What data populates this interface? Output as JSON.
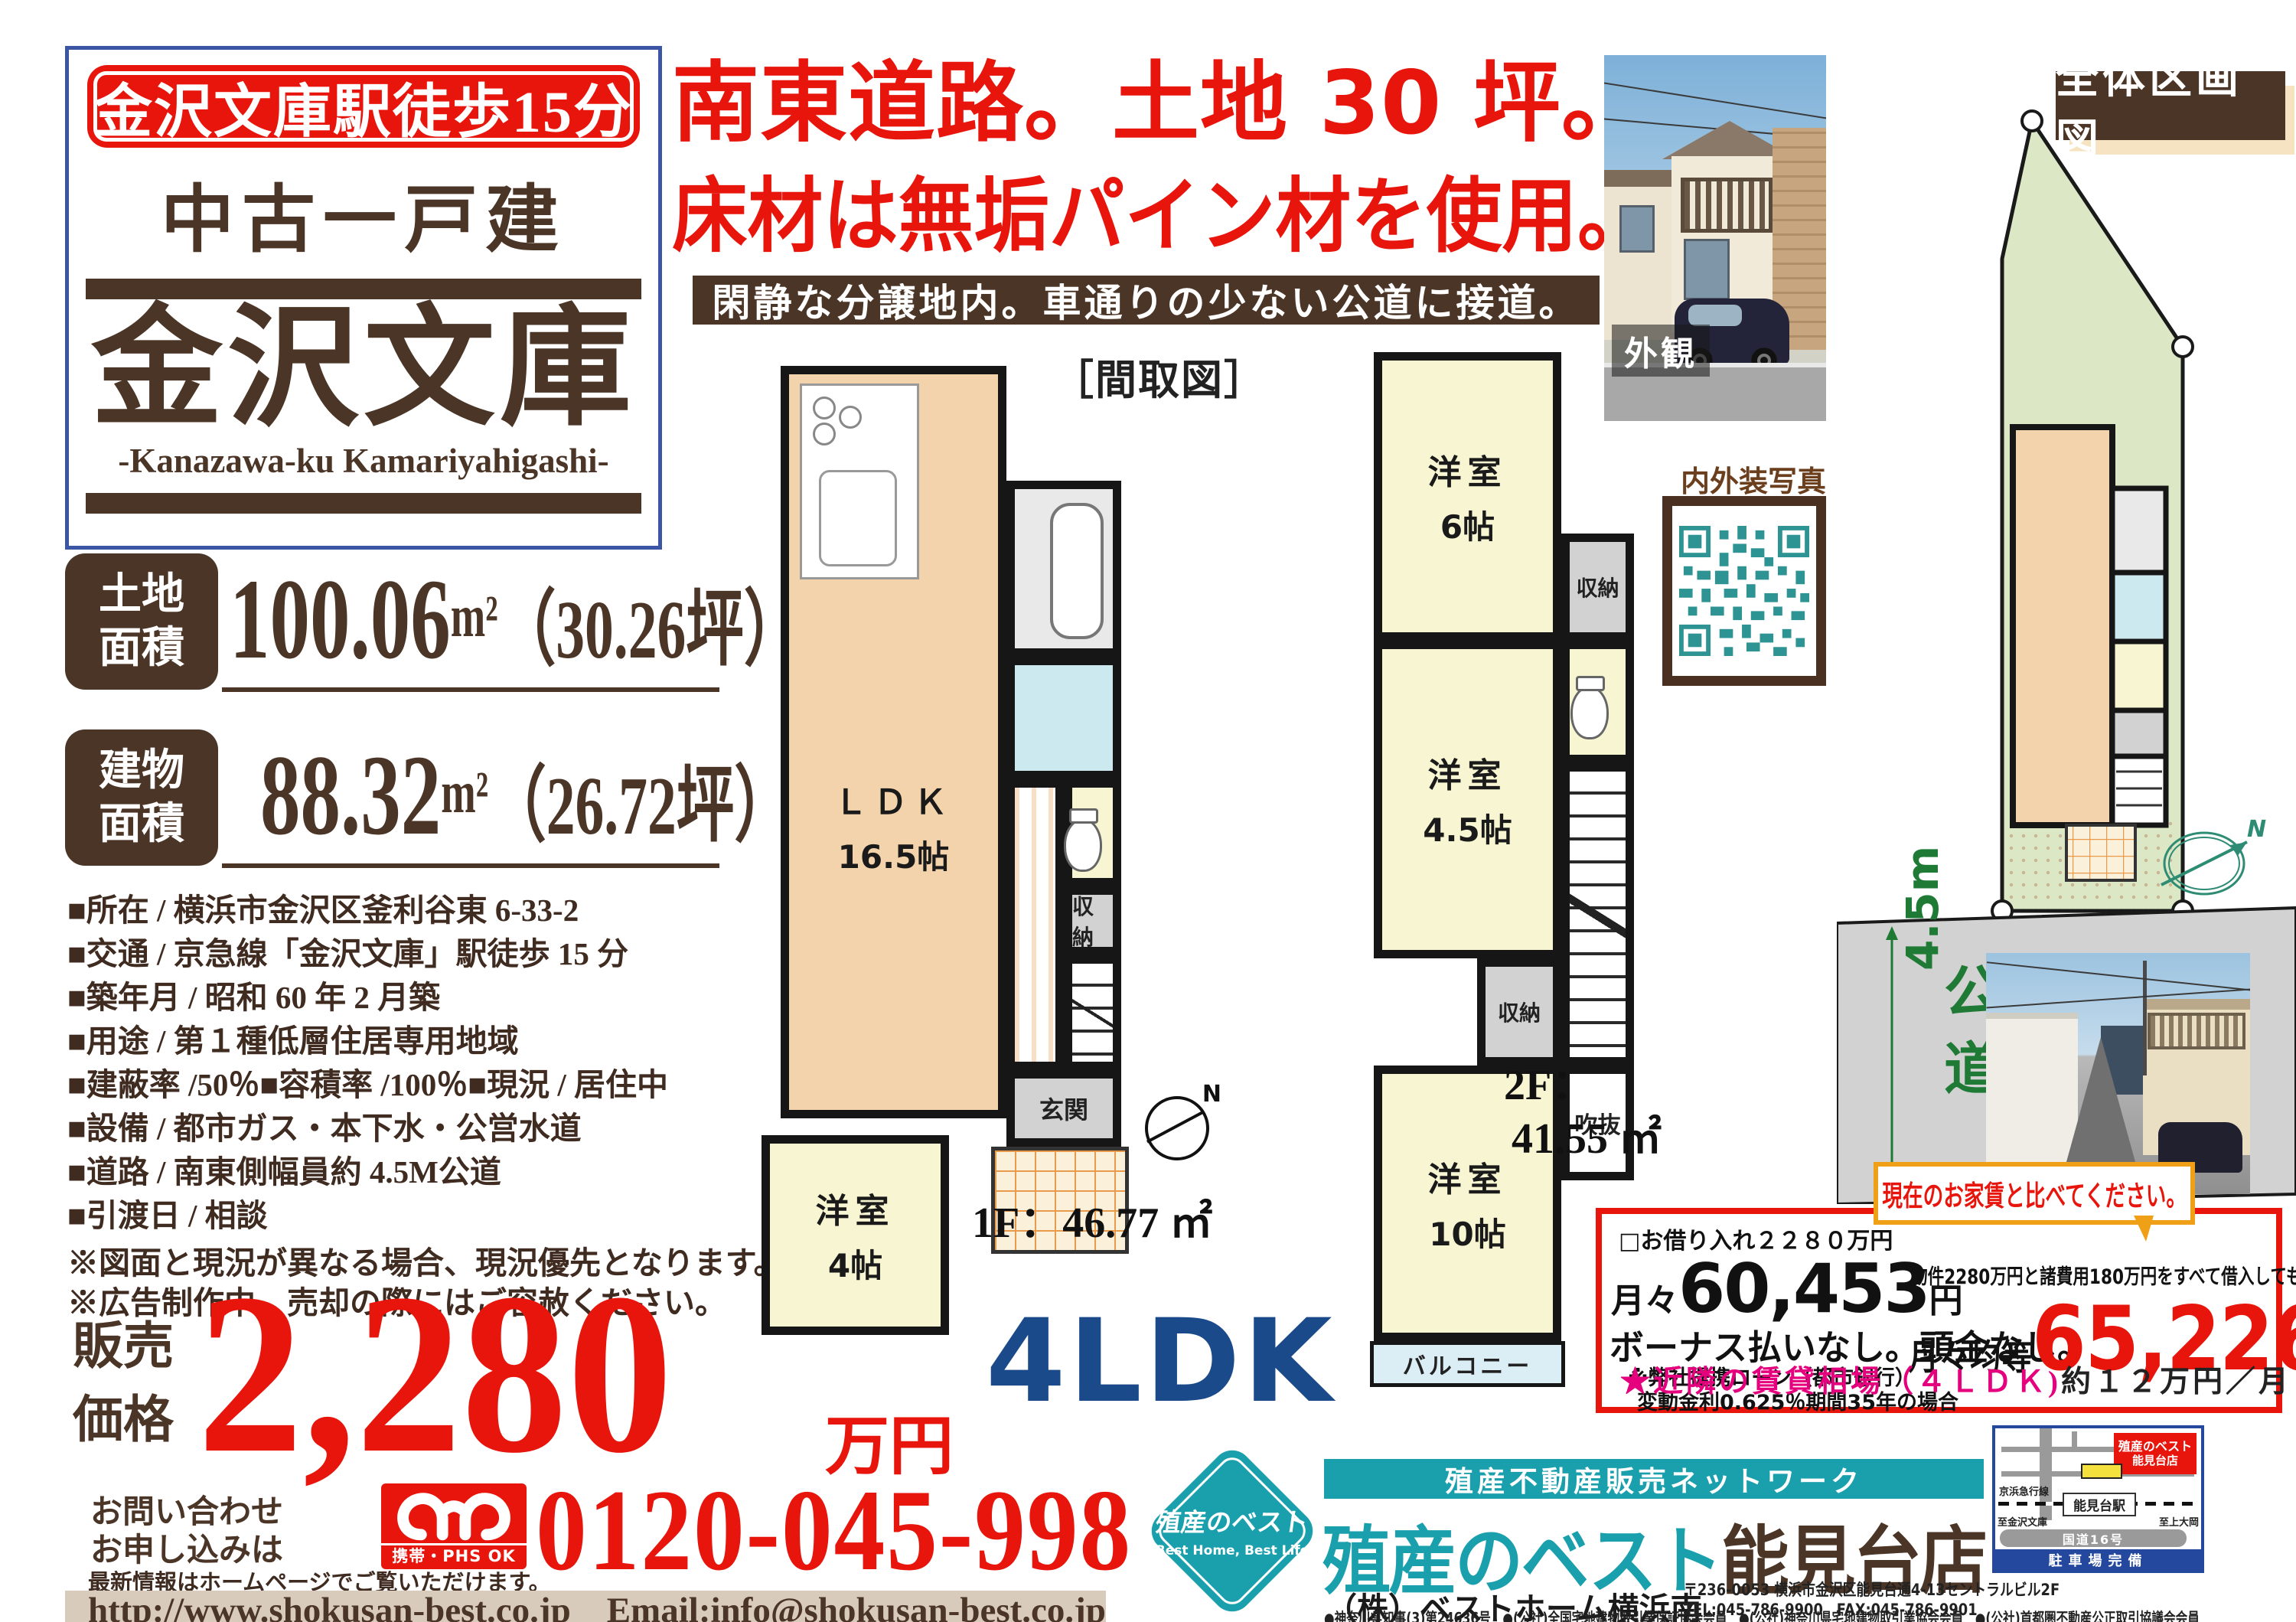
{
  "colors": {
    "brand_red": "#e8150d",
    "brand_brown": "#4b3526",
    "brand_teal": "#1aa0ad",
    "box_blue": "#3a56a5",
    "plan_type_blue": "#1b4a8a",
    "magenta": "#e5007e",
    "callout_orange": "#f0a016"
  },
  "header": {
    "badge": "金沢文庫駅徒歩15分",
    "property_type": "中古一戸建",
    "title": "金沢文庫",
    "romaji": "-Kanazawa-ku Kamariyahigashi-"
  },
  "headline": {
    "line1": "南東道路。土地 30 坪。",
    "line2": "床材は無垢パイン材を使用。",
    "banner": "閑静な分譲地内。車通りの少ない公道に接道。"
  },
  "photos": {
    "exterior_label": "外観",
    "qr_label": "内外装写真",
    "siteplan_title": "全体区画図",
    "road_text_1": "公",
    "road_text_2": "道",
    "road_width": "4.5m",
    "compass_n": "N"
  },
  "specs": {
    "land_label_1": "土地",
    "land_label_2": "面積",
    "land_num": "100.06",
    "land_unit": "m²",
    "land_tsubo": "（30.26坪）",
    "building_label_1": "建物",
    "building_label_2": "面積",
    "building_num": "88.32",
    "building_unit": "m²",
    "building_tsubo": "（26.72坪）",
    "details": [
      "■所在 / 横浜市金沢区釜利谷東 6-33-2",
      "■交通 / 京急線「金沢文庫」駅徒歩 15 分",
      "■築年月 / 昭和 60 年 2 月築",
      "■用途 / 第１種低層住居専用地域",
      "■建蔽率 /50％■容積率 /100％■現況 / 居住中",
      "■設備 / 都市ガス・本下水・公営水道",
      "■道路 / 南東側幅員約 4.5M公道",
      "■引渡日 / 相談"
    ],
    "notes": [
      "※図面と現況が異なる場合、現況優先となります。",
      "※広告制作中、売却の際にはご容赦ください。"
    ]
  },
  "price": {
    "label_1": "販売",
    "label_2": "価格",
    "amount": "2,280",
    "unit": "万円"
  },
  "floorplan": {
    "title": "［間取図］",
    "type": "4LDK",
    "f1_area": "1F：46.77 ㎡",
    "f2_area_1": "2F：",
    "f2_area_2": "41.55 ㎡",
    "f1": {
      "ldk": "ＬＤＫ",
      "ldk_size": "16.5帖",
      "room4": "洋室",
      "room4_size": "4帖",
      "genkan": "玄関",
      "closet": "収納"
    },
    "f2": {
      "room6": "洋室",
      "room6_size": "6帖",
      "room45": "洋室",
      "room45_size": "4.5帖",
      "room10": "洋室",
      "room10_size": "10帖",
      "closet1": "収納",
      "closet2": "収納",
      "void": "吹抜",
      "balcony": "バルコニー"
    }
  },
  "loan": {
    "borrow": "□お借り入れ２２８０万円",
    "monthly_label": "月々",
    "monthly_amount": "60,453",
    "monthly_unit": "円",
    "bonus": "ボーナス払いなし。頭金なし。",
    "note1": "※弊社提携ローン（都市銀行）",
    "note2": "変動金利0.625％期間35年の場合",
    "callout": "現在のお家賃と比べてください。",
    "total_note": "物件2280万円と諸費用180万円をすべて借入しても",
    "equal_label": "月々均等",
    "equal_amount": "65,226",
    "equal_unit": "円",
    "rent_label": "★近隣の賃貸相場（４ＬＤＫ)",
    "rent_value": "約１２万円／月"
  },
  "contact": {
    "inquiry_1": "お問い合わせ",
    "inquiry_2": "お申し込みは",
    "freedial_caption": "携帯・PHS OK",
    "phone": "0120-045-998",
    "homepage_note": "最新情報はホームページでご覧いただけます。",
    "url": "http://www.shokusan-best.co.jp　Email:info@shokusan-best.co.jp"
  },
  "company": {
    "network": "殖産不動産販売ネットワーク",
    "store_teal": "殖産のベスト",
    "store_brown": "能見台店",
    "firm": "（株）ベストホーム横浜南",
    "address": "〒236-0053 横浜市金沢区能見台通4-13セントラルビル2F",
    "tel_fax": "TEL:045-786-9900　FAX:045-786-9901",
    "licenses": "●神奈川県知事(3)第24636号　●(公社)全国宅地建物取引業保証協会会員　●(公社)神奈川県宅地建物取引業協会会員　●(公社)首都圏不動産公正取引協議会会員",
    "logo_main": "殖産のベスト",
    "logo_sub": "Best Home, Best Life"
  },
  "map": {
    "store_1": "殖産のベスト",
    "store_2": "能見台店",
    "rail_name": "京浜急行線",
    "station": "能見台駅",
    "dir_left": "至金沢文庫",
    "dir_right": "至上大岡",
    "route": "国道16号",
    "landmark": "ロイヤルホスト",
    "footer": "駐車場完備"
  }
}
